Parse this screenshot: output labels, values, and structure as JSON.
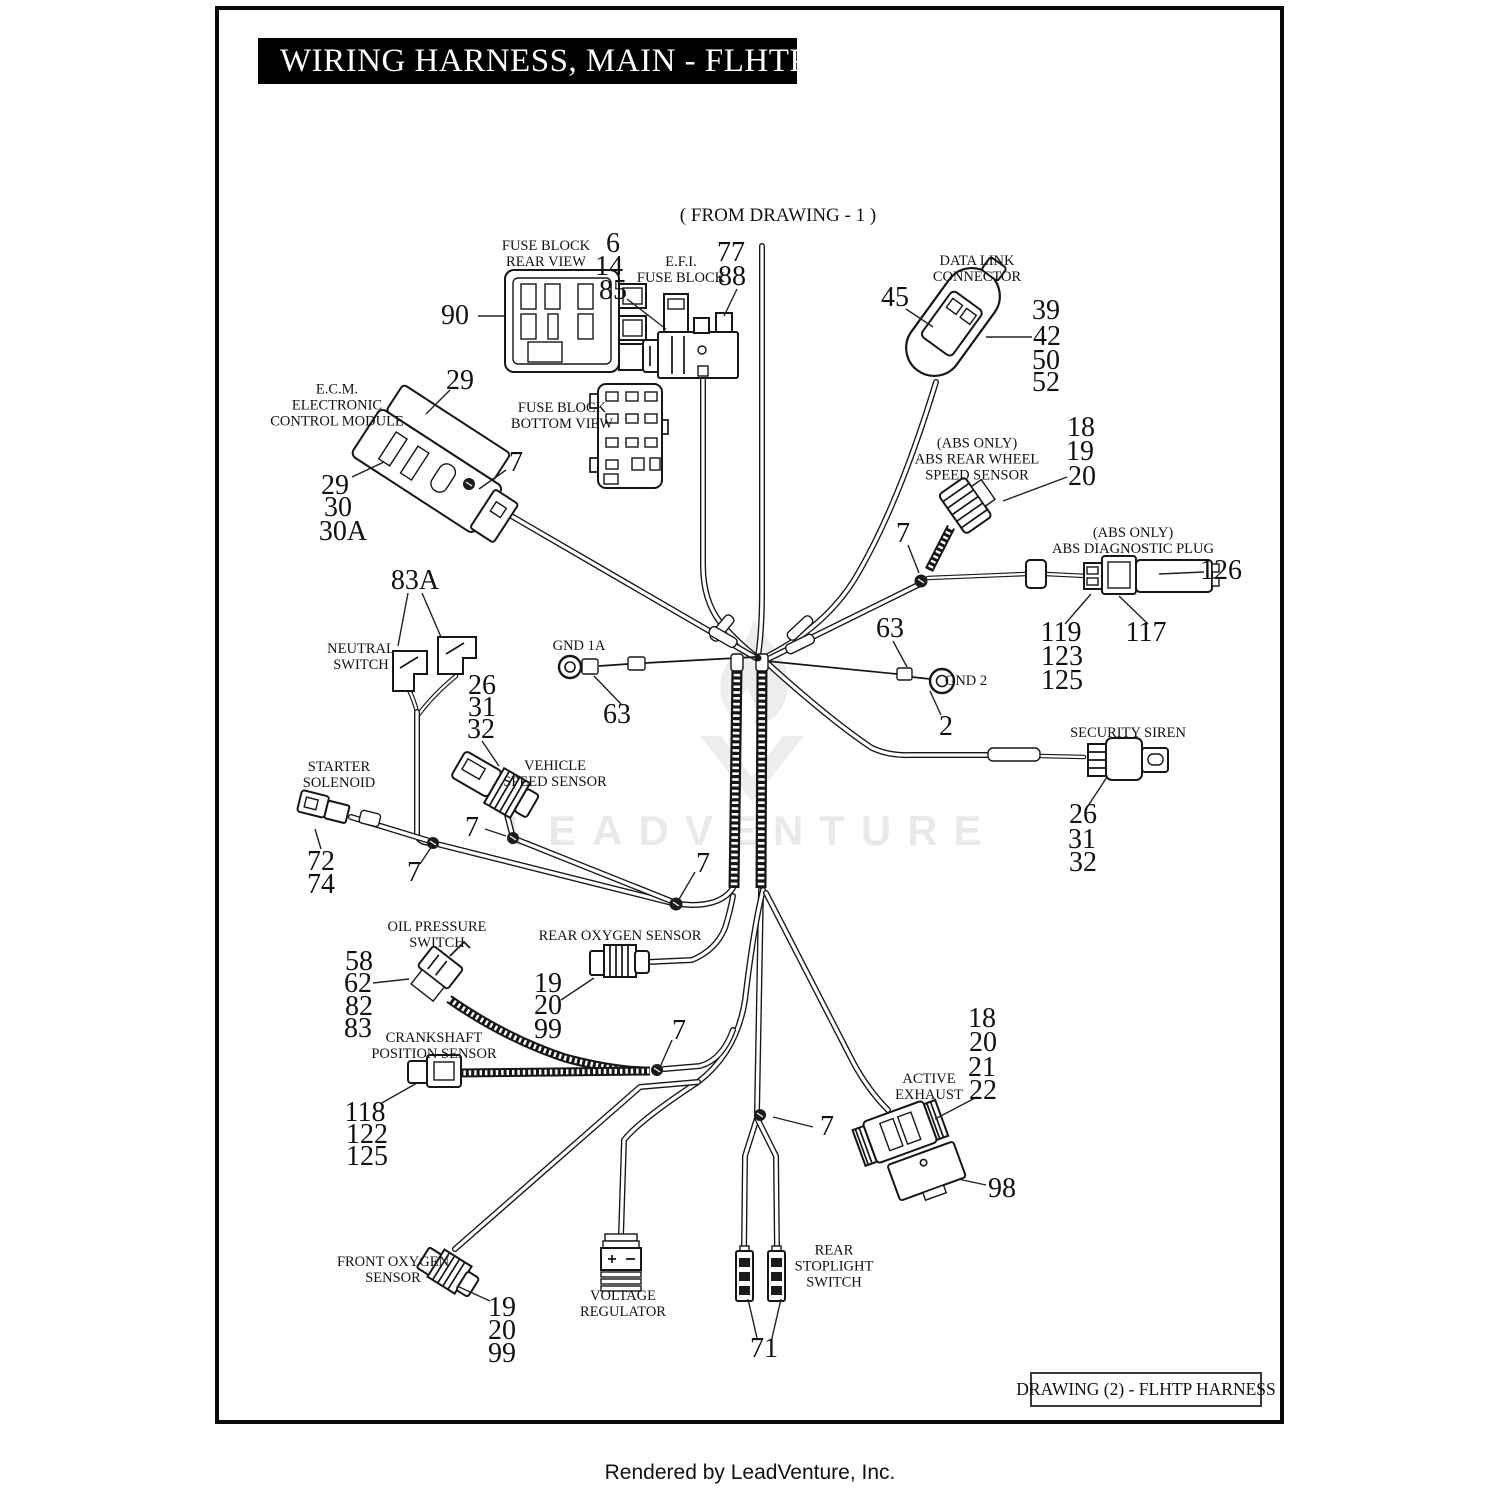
{
  "page": {
    "title": "WIRING HARNESS, MAIN - FLHTP",
    "from_drawing_note": "( FROM DRAWING - 1 )",
    "drawing_caption": "DRAWING (2) - FLHTP HARNESS",
    "footer": "Rendered by LeadVenture, Inc.",
    "watermark": "LEADVENTURE"
  },
  "component_labels": [
    {
      "id": "fuse-block-rear-view",
      "t": "FUSE BLOCK\nREAR VIEW"
    },
    {
      "id": "efi-fuse-block",
      "t": "E.F.I.\nFUSE BLOCK"
    },
    {
      "id": "data-link-connector",
      "t": "DATA LINK\nCONNECTOR"
    },
    {
      "id": "ecm",
      "t": "E.C.M.\nELECTRONIC\nCONTROL MODULE"
    },
    {
      "id": "fuse-block-bottom-view",
      "t": "FUSE BLOCK\nBOTTOM VIEW"
    },
    {
      "id": "abs-rear-wheel-speed-sensor",
      "t": "(ABS ONLY)\nABS REAR WHEEL\nSPEED SENSOR"
    },
    {
      "id": "abs-diagnostic-plug",
      "t": "(ABS ONLY)\nABS DIAGNOSTIC PLUG"
    },
    {
      "id": "neutral-switch",
      "t": "NEUTRAL\nSWITCH"
    },
    {
      "id": "gnd-1a",
      "t": "GND 1A"
    },
    {
      "id": "gnd-2",
      "t": "GND 2"
    },
    {
      "id": "vehicle-speed-sensor",
      "t": "VEHICLE\nSPEED SENSOR"
    },
    {
      "id": "starter-solenoid",
      "t": "STARTER\nSOLENOID"
    },
    {
      "id": "security-siren",
      "t": "SECURITY SIREN"
    },
    {
      "id": "oil-pressure-switch",
      "t": "OIL PRESSURE\nSWITCH"
    },
    {
      "id": "rear-oxygen-sensor",
      "t": "REAR OXYGEN SENSOR"
    },
    {
      "id": "crankshaft-position-sensor",
      "t": "CRANKSHAFT\nPOSITION SENSOR"
    },
    {
      "id": "front-oxygen-sensor",
      "t": "FRONT OXYGEN\nSENSOR"
    },
    {
      "id": "voltage-regulator",
      "t": "VOLTAGE\nREGULATOR"
    },
    {
      "id": "active-exhaust",
      "t": "ACTIVE\nEXHAUST"
    },
    {
      "id": "rear-stoplight-switch",
      "t": "REAR\nSTOPLIGHT\nSWITCH"
    }
  ],
  "part_numbers": [
    {
      "t": "90"
    },
    {
      "t": "6"
    },
    {
      "t": "14"
    },
    {
      "t": "85"
    },
    {
      "t": "77"
    },
    {
      "t": "88"
    },
    {
      "t": "45"
    },
    {
      "t": "39"
    },
    {
      "t": "42"
    },
    {
      "t": "50"
    },
    {
      "t": "52"
    },
    {
      "t": "29"
    },
    {
      "t": "7"
    },
    {
      "t": "29"
    },
    {
      "t": "30"
    },
    {
      "t": "30A"
    },
    {
      "t": "83A"
    },
    {
      "t": "18"
    },
    {
      "t": "19"
    },
    {
      "t": "20"
    },
    {
      "t": "7"
    },
    {
      "t": "126"
    },
    {
      "t": "119"
    },
    {
      "t": "123"
    },
    {
      "t": "125"
    },
    {
      "t": "117"
    },
    {
      "t": "63"
    },
    {
      "t": "2"
    },
    {
      "t": "63"
    },
    {
      "t": "26"
    },
    {
      "t": "31"
    },
    {
      "t": "32"
    },
    {
      "t": "26"
    },
    {
      "t": "31"
    },
    {
      "t": "32"
    },
    {
      "t": "72"
    },
    {
      "t": "74"
    },
    {
      "t": "7"
    },
    {
      "t": "7"
    },
    {
      "t": "7"
    },
    {
      "t": "58"
    },
    {
      "t": "62"
    },
    {
      "t": "82"
    },
    {
      "t": "83"
    },
    {
      "t": "19"
    },
    {
      "t": "20"
    },
    {
      "t": "99"
    },
    {
      "t": "7"
    },
    {
      "t": "118"
    },
    {
      "t": "122"
    },
    {
      "t": "125"
    },
    {
      "t": "19"
    },
    {
      "t": "20"
    },
    {
      "t": "99"
    },
    {
      "t": "18"
    },
    {
      "t": "20"
    },
    {
      "t": "21"
    },
    {
      "t": "22"
    },
    {
      "t": "7"
    },
    {
      "t": "98"
    },
    {
      "t": "71"
    }
  ]
}
